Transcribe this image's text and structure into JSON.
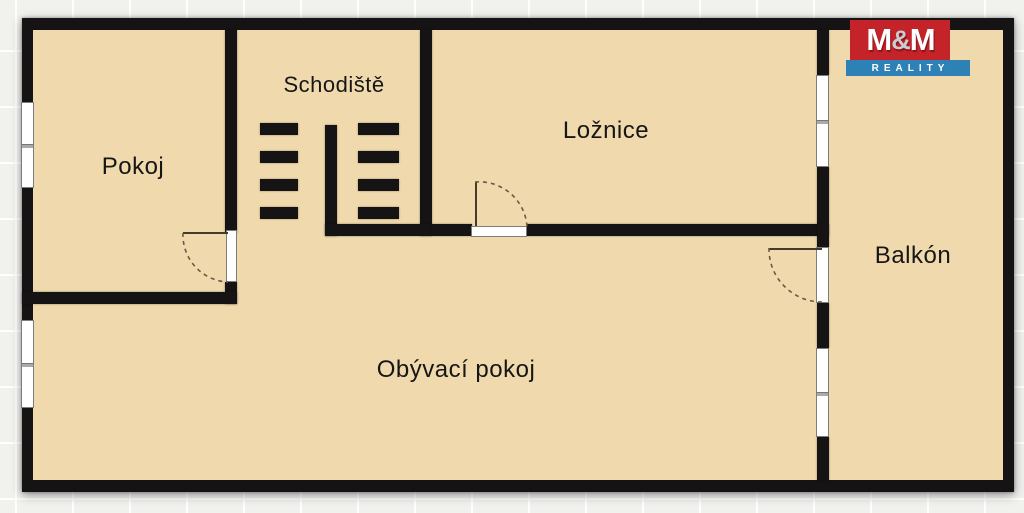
{
  "floorplan": {
    "rooms": [
      {
        "name": "pokoj",
        "label": "Pokoj"
      },
      {
        "name": "schodiste",
        "label": "Schodiště"
      },
      {
        "name": "loznice",
        "label": "Ložnice"
      },
      {
        "name": "balkon",
        "label": "Balkón"
      },
      {
        "name": "obyvaci-pokoj",
        "label": "Obývací pokoj"
      }
    ],
    "colors": {
      "floor": "#f0daad",
      "wall": "#151313",
      "canvas": "#f1f1ee",
      "window": "#ffffff",
      "door_arc": "#6b5944"
    }
  },
  "logo": {
    "m_left": "M",
    "ampersand": "&",
    "m_right": "M",
    "tagline": "REALITY",
    "colors": {
      "brand_bg": "#c4232a",
      "tagline_bg": "#2e81b7",
      "text": "#ffffff",
      "ampersand_color": "#c9cdd1"
    }
  }
}
